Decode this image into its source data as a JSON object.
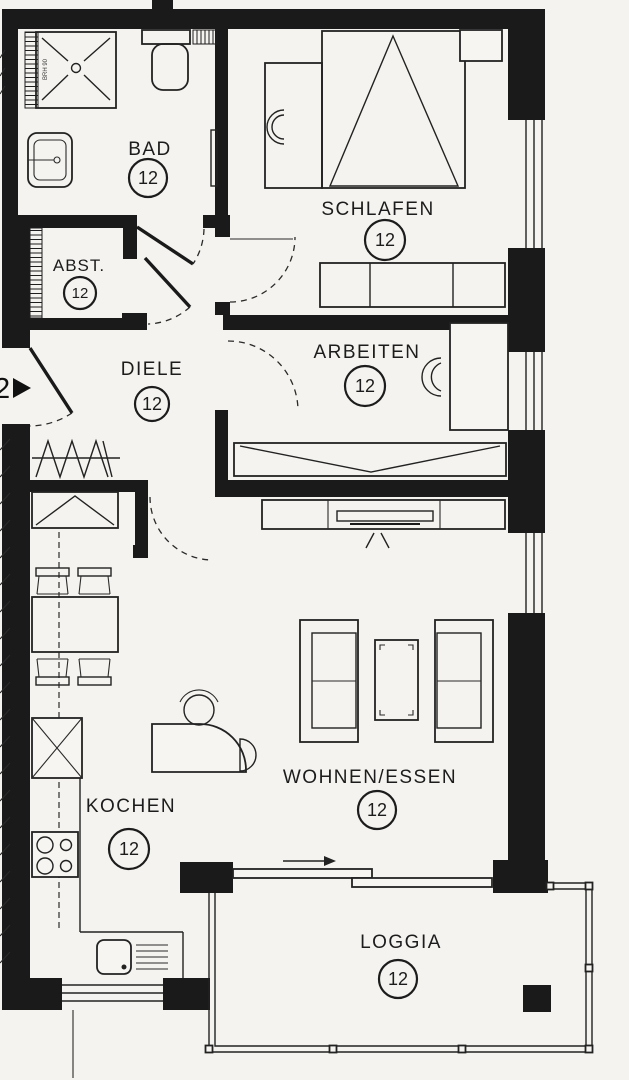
{
  "plan": {
    "rooms": {
      "bad": {
        "label": "BAD",
        "number": "12"
      },
      "schlafen": {
        "label": "SCHLAFEN",
        "number": "12"
      },
      "abst": {
        "label": "ABST.",
        "number": "12"
      },
      "diele": {
        "label": "DIELE",
        "number": "12"
      },
      "arbeiten": {
        "label": "ARBEITEN",
        "number": "12"
      },
      "kochen": {
        "label": "KOCHEN",
        "number": "12"
      },
      "wohnen_essen": {
        "label": "WOHNEN/ESSEN",
        "number": "12"
      },
      "loggia": {
        "label": "LOGGIA",
        "number": "12"
      }
    },
    "entrance": {
      "unit_marker": "2"
    },
    "annotations": {
      "window_sill_label": "BRH 90"
    },
    "colors": {
      "wall": "#1a1a1a",
      "line": "#222222",
      "background": "#f4f3ef"
    }
  }
}
